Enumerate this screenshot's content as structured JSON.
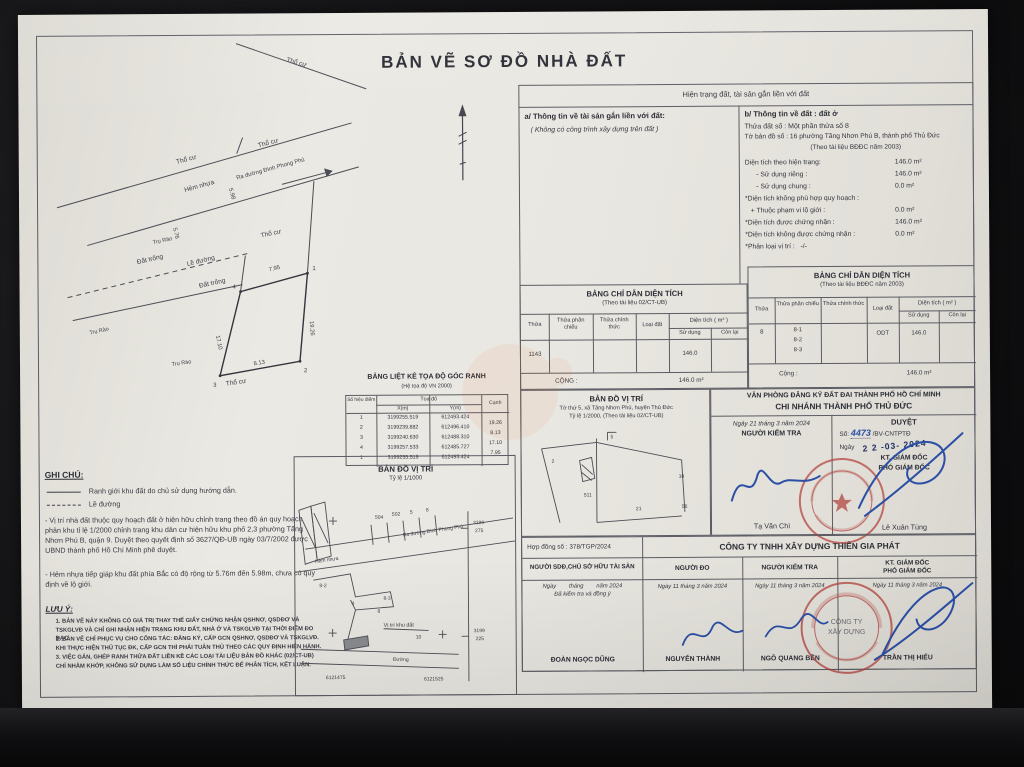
{
  "title": "BẢN VẼ SƠ ĐỒ NHÀ ĐẤT",
  "status_header": "Hiện trạng đất, tài sản gắn liền với đất",
  "asset_info": {
    "heading": "a/ Thông tin về tài sản gắn liền với đất:",
    "note": "( Không có công trình xây dựng trên đất )"
  },
  "land_info": {
    "heading": "b/ Thông tin về đất : đất ở",
    "parcel_line": "Thửa đất số :   Một phần thửa số 8",
    "sheet_line": "Tờ bản đồ số : 16 phường Tăng Nhơn Phú B, thành phố Thủ Đức",
    "doc_ref": "(Theo tài liệu BĐĐC năm 2003)",
    "rows": [
      {
        "label": "Diện tích theo hiện trạng:",
        "value": "146.0 m²"
      },
      {
        "label": "      - Sử dụng riêng :",
        "value": "146.0 m²"
      },
      {
        "label": "      - Sử dụng chung :",
        "value": "0.0 m²"
      },
      {
        "label": "*Diện tích không phù hợp quy hoạch :",
        "value": ""
      },
      {
        "label": "   + Thuộc phạm vi lộ giới :",
        "value": "0.0 m²"
      },
      {
        "label": "*Diện tích được chứng nhận :",
        "value": "146.0 m²"
      },
      {
        "label": "*Diện tích không được chứng nhận :",
        "value": "0.0 m²"
      },
      {
        "label": "*Phân loại vị trí :   -/-",
        "value": ""
      }
    ]
  },
  "area_table_left": {
    "title": "BẢNG CHỈ DẪN DIỆN TÍCH",
    "subtitle": "(Theo tài liệu 02/CT-UB)",
    "h_thua": "Thửa",
    "h_phan_chieu": "Thửa phân chiếu",
    "h_chinh_thuc": "Thửa chính thức",
    "h_loai_dat": "Loại đất",
    "h_dien_tich": "Diện tích  ( m² )",
    "h_su_dung": "Sử dụng",
    "h_con_lai": "Còn lại",
    "thua": "1143",
    "su_dung": "146.0",
    "total_label": "CỘNG :",
    "total_value": "146.0 m²"
  },
  "area_table_right": {
    "title": "BẢNG CHỈ DẪN DIỆN TÍCH",
    "subtitle": "(Theo tài liệu BĐĐC năm 2003)",
    "h_thua": "Thửa",
    "h_phan_chieu": "Thửa phân chiếu",
    "h_chinh_thuc": "Thửa chính thức",
    "h_loai_dat": "Loại đất",
    "h_dien_tich": "Diện tích  ( m² )",
    "h_su_dung": "Sử dụng",
    "h_con_lai": "Còn lại",
    "thua": "8",
    "pc1": "8-1",
    "pc2": "8-2",
    "pc3": "8-3",
    "loai_dat": "ODT",
    "su_dung": "146.0",
    "total_label": "Cộng :",
    "total_value": "146.0 m²"
  },
  "coord_table": {
    "title": "BẢNG LIỆT KÊ TỌA ĐỘ GÓC RANH",
    "subtitle": "(Hệ tọa độ VN 2000)",
    "h_point": "Số hiệu điểm",
    "h_coord": "Tọa độ",
    "h_x": "X(m)",
    "h_y": "Y(m)",
    "h_edge": "Cạnh",
    "rows": [
      {
        "p": "1",
        "x": "3199255.519",
        "y": "612493.424",
        "e": ""
      },
      {
        "p": "2",
        "x": "3199239.882",
        "y": "612496.410",
        "e": "19.26"
      },
      {
        "p": "3",
        "x": "3199240.630",
        "y": "612488.310",
        "e": "8.13"
      },
      {
        "p": "4",
        "x": "3199257.533",
        "y": "612485.727",
        "e": "17.10"
      },
      {
        "p": "1",
        "x": "3199255.519",
        "y": "612493.424",
        "e": "7.95"
      }
    ]
  },
  "ghi_chu": {
    "heading": "GHI CHÚ:",
    "legend_solid": "Ranh giới khu đất do chủ sử dụng hướng dẫn.",
    "legend_dashed": "Lề đường",
    "para1": "- Vị trí nhà đất thuộc quy hoạch đất ở hiện hữu chỉnh trang theo đồ án quy hoạch phân khu tỉ lệ 1/2000 chỉnh trang khu dân cư hiện hữu khu phố 2,3 phường Tăng Nhơn Phú B, quận 9. Duyệt theo quyết định số 3627/QĐ-UB ngày 03/7/2002 được UBND thành phố Hồ Chí Minh phê duyệt.",
    "para2": "- Hẻm nhựa tiếp giáp khu đất phía Bắc có độ rộng từ 5.76m đến 5.98m, chưa có quy định về lộ giới."
  },
  "luu_y": {
    "heading": "LƯU Ý:",
    "item1": "1. BẢN VẼ NÀY KHÔNG CÓ GIÁ TRỊ THAY THẾ GIẤY CHỨNG NHẬN QSHNƠ, QSDĐƠ VÀ TSKGLVĐ VÀ CHỈ GHI NHẬN HIỆN TRẠNG KHU ĐẤT, NHÀ Ở VÀ TSKGLVĐ TẠI THỜI ĐIỂM ĐO ĐẠC.",
    "item2": "2. BẢN VẼ CHỈ PHỤC VỤ CHO CÔNG TÁC: ĐĂNG KÝ, CẤP GCN QSHNƠ, QSDĐƠ VÀ TSKGLVĐ. KHI THỰC HIỆN THỦ TỤC ĐK, CẤP GCN THÌ PHẢI TUÂN THỦ THEO CÁC QUY ĐỊNH HIỆN HÀNH.",
    "item3": "3. VIỆC GẮN, GHÉP RANH THỬA ĐẤT LIỀN KỀ CÁC LOẠI TÀI LIỆU BẢN ĐỒ KHÁC (02/CT-UB) CHỈ NHẰM KHỚP, KHÔNG SỬ DỤNG LÀM SỐ LIỆU CHÍNH THỨC ĐỂ PHÂN TÍCH, KẾT LUẬN."
  },
  "drawing": {
    "tho_cu": "Thổ cư",
    "hem_nhua": "Hẻm nhựa",
    "le_duong": "Lề đường",
    "dat_trong": "Đất trống",
    "tru_rao": "Trụ Rào",
    "ra_duong": "Ra đường Đình Phong Phú",
    "d_576": "5.76",
    "d_598": "5.98",
    "d_795": "7.95",
    "d_1926": "19.26",
    "d_813": "8.13",
    "d_1710": "17.10",
    "p1": "1",
    "p2": "2",
    "p3": "3",
    "p4": "4"
  },
  "map_1000": {
    "title": "BẢN ĐỒ VỊ TRÍ",
    "scale": "Tỷ lệ 1/1000",
    "road": "Ra đường Đình Phong Phú",
    "hem": "Hẻm nhựa",
    "pa": "504",
    "pb": "502",
    "pc": "5",
    "pd": "8",
    "p82": "8-2",
    "p83": "8-3",
    "p4": "4",
    "p8": "8",
    "p10": "10",
    "vi_tri": "Vị trí khu đất",
    "duong": "Đường",
    "gr1a": "3199",
    "gr1b": "275",
    "gr2a": "3199",
    "gr2b": "225",
    "gb1": "6121475",
    "gb2": "6121525"
  },
  "map_2000": {
    "title": "BẢN ĐỒ VỊ TRÍ",
    "line1": "Tờ thứ 5, xã Tăng Nhơn Phú, huyện Thủ Đức",
    "line2": "Tỷ lệ 1/2000, (Theo tài liệu 02/CT-UB)",
    "n1": "2",
    "n2": "511",
    "n3": "5",
    "n4": "39",
    "n5": "56",
    "n6": "21"
  },
  "registry": {
    "office_1": "VĂN PHÒNG ĐĂNG KÝ ĐẤT ĐAI THÀNH PHỐ HỒ CHÍ MINH",
    "office_2": "CHI NHÁNH THÀNH PHỐ THỦ ĐỨC",
    "checker_date": "Ngày 21 tháng 3 năm 2024",
    "checker_title": "NGƯỜI KIỂM TRA",
    "checker_name": "Tạ Văn Chì",
    "approve_title": "DUYỆT",
    "approve_no_prefix": "Số:",
    "approve_no": "4473",
    "approve_no_suffix": "/BV-CNTPTĐ",
    "approve_date_prefix": "Ngày",
    "approve_date_stamp": "2 2 -03- 2024",
    "approve_kt": "KT. GIÁM ĐỐC",
    "approve_pho": "PHÓ GIÁM ĐỐC",
    "approver_name": "Lê Xuân Tùng"
  },
  "company": {
    "contract": "Hợp đồng số : 378/TGP/2024",
    "name": "CÔNG TY TNHH XÂY DỰNG THIÊN GIA PHÁT",
    "col1_title": "NGƯỜI SDĐ,CHỦ SỞ HỮU TÀI SẢN",
    "col2_title": "NGƯỜI ĐO",
    "col3_title": "NGƯỜI KIỂM TRA",
    "col4_title_1": "KT. GIÁM ĐỐC",
    "col4_title_2": "PHÓ GIÁM ĐỐC",
    "col1_date": "Ngày        tháng        năm 2024",
    "col1_note": "Đã kiểm tra và đồng ý",
    "col2_date": "Ngày 11 tháng 3 năm 2024",
    "col3_date": "Ngày 11 tháng 3 năm 2024",
    "col4_date": "Ngày 11 tháng 3 năm 2024",
    "col1_name": "ĐOÀN NGỌC DŨNG",
    "col2_name": "NGUYỄN THÀNH",
    "col3_name": "NGÔ QUANG BỀN",
    "col4_name": "TRẦN THỊ HIẾU",
    "stamp_l1": "CÔNG TY",
    "stamp_l2": "XÂY DỰNG"
  }
}
